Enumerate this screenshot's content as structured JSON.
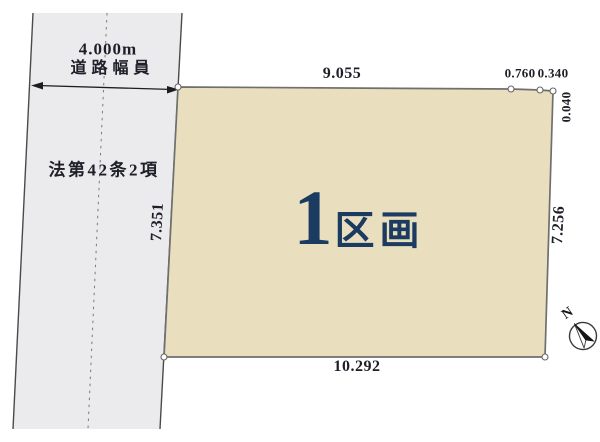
{
  "road": {
    "width_value": "4.000m",
    "width_caption": "道路幅員",
    "law_label": "法第42条2項"
  },
  "plot": {
    "number": "1",
    "suffix": "区画",
    "dims": {
      "top": "9.055",
      "bottom": "10.292",
      "left": "7.351",
      "right": "7.256",
      "top_right_a": "0.760",
      "top_right_b": "0.340",
      "right_top": "0.040"
    }
  },
  "compass": {
    "north": "N"
  },
  "colors": {
    "plot_fill": "#e9dfbf",
    "road_fill": "#ebebee",
    "navy": "#1c3b60",
    "ink": "#1f1f28",
    "line": "#6f6f6f"
  }
}
